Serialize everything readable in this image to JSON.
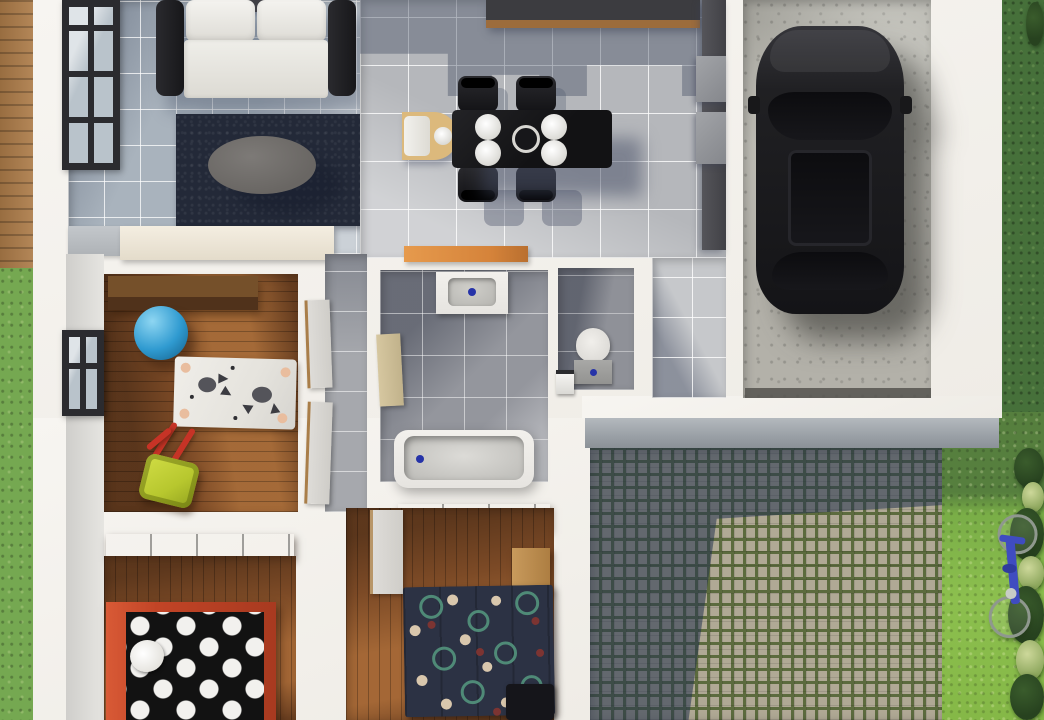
{
  "scene": {
    "kind": "3d-rendered-floor-plan",
    "view": "top-down",
    "rooms": [
      {
        "id": "living-room",
        "floor": "blue-gray-tile",
        "furniture": [
          "sofa",
          "area-rug",
          "oval-coffee-table",
          "sideboard",
          "window"
        ]
      },
      {
        "id": "kitchen-dining",
        "floor": "light-gray-tile",
        "furniture": [
          "dining-table",
          "four-chairs",
          "four-plates",
          "center-bowl",
          "highchair",
          "north-counter",
          "east-cabinets",
          "orange-island"
        ]
      },
      {
        "id": "garage",
        "floor": "concrete",
        "furniture": [
          "black-car"
        ]
      },
      {
        "id": "kids-room",
        "floor": "dark-wood",
        "furniture": [
          "desk",
          "blue-gym-ball",
          "animal-rug",
          "toy-wheelbarrow",
          "window"
        ]
      },
      {
        "id": "bathroom",
        "floor": "gray-tile",
        "furniture": [
          "sink-vanity",
          "bathtub",
          "wood-door"
        ]
      },
      {
        "id": "wc",
        "floor": "gray-tile",
        "furniture": [
          "toilet",
          "waste-bin"
        ]
      },
      {
        "id": "bedroom-west",
        "floor": "wood",
        "furniture": [
          "wardrobe",
          "polka-dot-bed",
          "pillow"
        ]
      },
      {
        "id": "bedroom-middle",
        "floor": "wood",
        "furniture": [
          "wardrobe",
          "circle-pattern-rug",
          "wood-bench",
          "door",
          "bed-corner"
        ]
      },
      {
        "id": "hallway",
        "floor": "light-tile",
        "furniture": []
      },
      {
        "id": "corridor",
        "floor": "gray-tile",
        "furniture": [
          "door-panels"
        ]
      }
    ],
    "outdoor": [
      {
        "id": "west-deck",
        "surface": "wood-planks"
      },
      {
        "id": "west-lawn",
        "surface": "grass"
      },
      {
        "id": "east-lawn",
        "surface": "grass",
        "items": [
          "blue-bicycle",
          "bushes",
          "flower-bushes"
        ]
      },
      {
        "id": "patio",
        "surface": "cobblestone-with-moss",
        "items": [
          "building-shadow"
        ]
      }
    ]
  },
  "palette": {
    "wall": "#f2efe9",
    "deck_wood": "#ad7c49",
    "grass_left": "#75a851",
    "grass_dark": "#46703a",
    "grass_bright": "#8cbf4e",
    "grass_shadow": "#567f3e",
    "tile_living": "#a9b3bd",
    "tile_dining": "#b5b7bb",
    "tile_bath": "#94969d",
    "wood_floor": "#7c4a26",
    "concrete": "#b3b1a9",
    "rug_navy": "#232938",
    "table_gray": "#696663",
    "table_black": "#121214",
    "counter_dark": "#3c3c40",
    "counter_wood": "#9c6c3c",
    "cabinet_dark": "#414146",
    "island_orange": "#d5833a",
    "highchair_wood": "#dcb97c",
    "car_body": "#1a1a1d",
    "porcelain": "#e6e4e0",
    "basin_gray": "#b5b4b0",
    "drain_blue": "#2633a8",
    "tank_gray": "#939391",
    "door_wood": "#c1b28b",
    "wardrobe": "#533317",
    "wardrobe_light": "#75502a",
    "ball_blue": "#2f9ad0",
    "rug_white": "#e5e3dd",
    "animal_peach": "#e9bd9e",
    "barrow_yellow": "#b7c72e",
    "barrow_red": "#c63326",
    "bed_red": "#c24426",
    "blanket_black": "#121212",
    "dot_white": "#f2f1ee",
    "rug_mid_navy": "#2c3244",
    "ring_teal": "#4f8a77",
    "dot_cream": "#d9c7ad",
    "dot_red": "#7c3432",
    "bench_wood": "#ad7e42",
    "cobble_sun": "#b0a995",
    "cobble_moss": "#5c6b3e",
    "bike_blue": "#3f4cc0",
    "bike_wheel": "#8f988e",
    "window_frame": "#2b2b2f",
    "glass": "#b9c3cb"
  }
}
